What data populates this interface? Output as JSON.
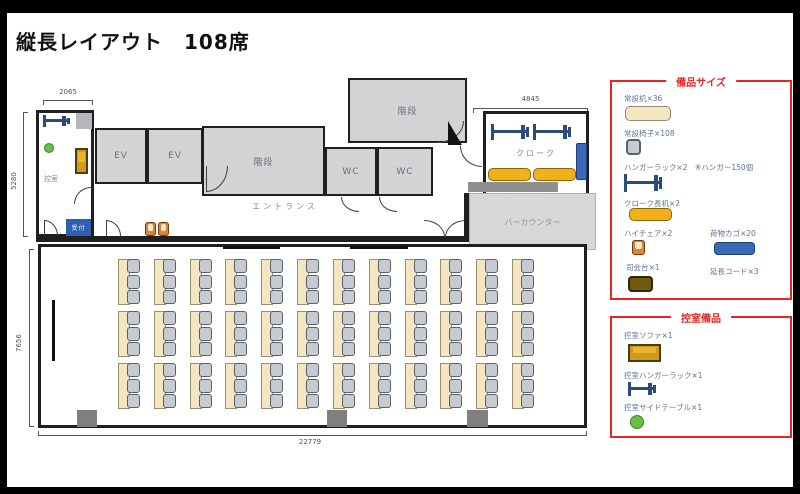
{
  "title": "縦長レイアウト　108席",
  "colors": {
    "accent_red": "#e8251f",
    "rack_navy": "#2e4a7a",
    "desk_beige": "#f4e6c0",
    "chair_gray": "#c7cbd1",
    "cloak_gold": "#f2b01e",
    "basket_blue": "#3c69b5",
    "table_green": "#6cbf3f",
    "room_gray": "#d3d3d6"
  },
  "plan": {
    "dims": {
      "waiting_room_width": "2065",
      "upper_height": "5280",
      "hall_height": "7656",
      "bottom_width": "22779",
      "cloak_width": "4845"
    },
    "labels": {
      "waiting_room": "控室",
      "reception": "受付",
      "ev": "EV",
      "stairs": "階段",
      "wc": "WC",
      "entrance": "エントランス",
      "cloak": "クローク",
      "bar_counter": "バーカウンター"
    },
    "seating": {
      "rows": 3,
      "cols": 12,
      "chairs_per_table": 3,
      "total_tables": 36,
      "total_seats": 108
    }
  },
  "legend_equipment": {
    "title": "備品サイズ",
    "items": {
      "desk": "常設机×36",
      "chair": "常設椅子×108",
      "hanger": "ハンガーラック×2　※ハンガー150個",
      "cloak_desk": "クローク長机×2",
      "high_chair": "ハイチェア×2",
      "basket": "荷物カゴ×20",
      "podium": "司会台×1",
      "cord": "延長コード×3"
    }
  },
  "legend_waiting": {
    "title": "控室備品",
    "items": {
      "sofa": "控室ソファ×1",
      "hanger": "控室ハンガーラック×1",
      "side_table": "控室サイドテーブル×1"
    }
  }
}
